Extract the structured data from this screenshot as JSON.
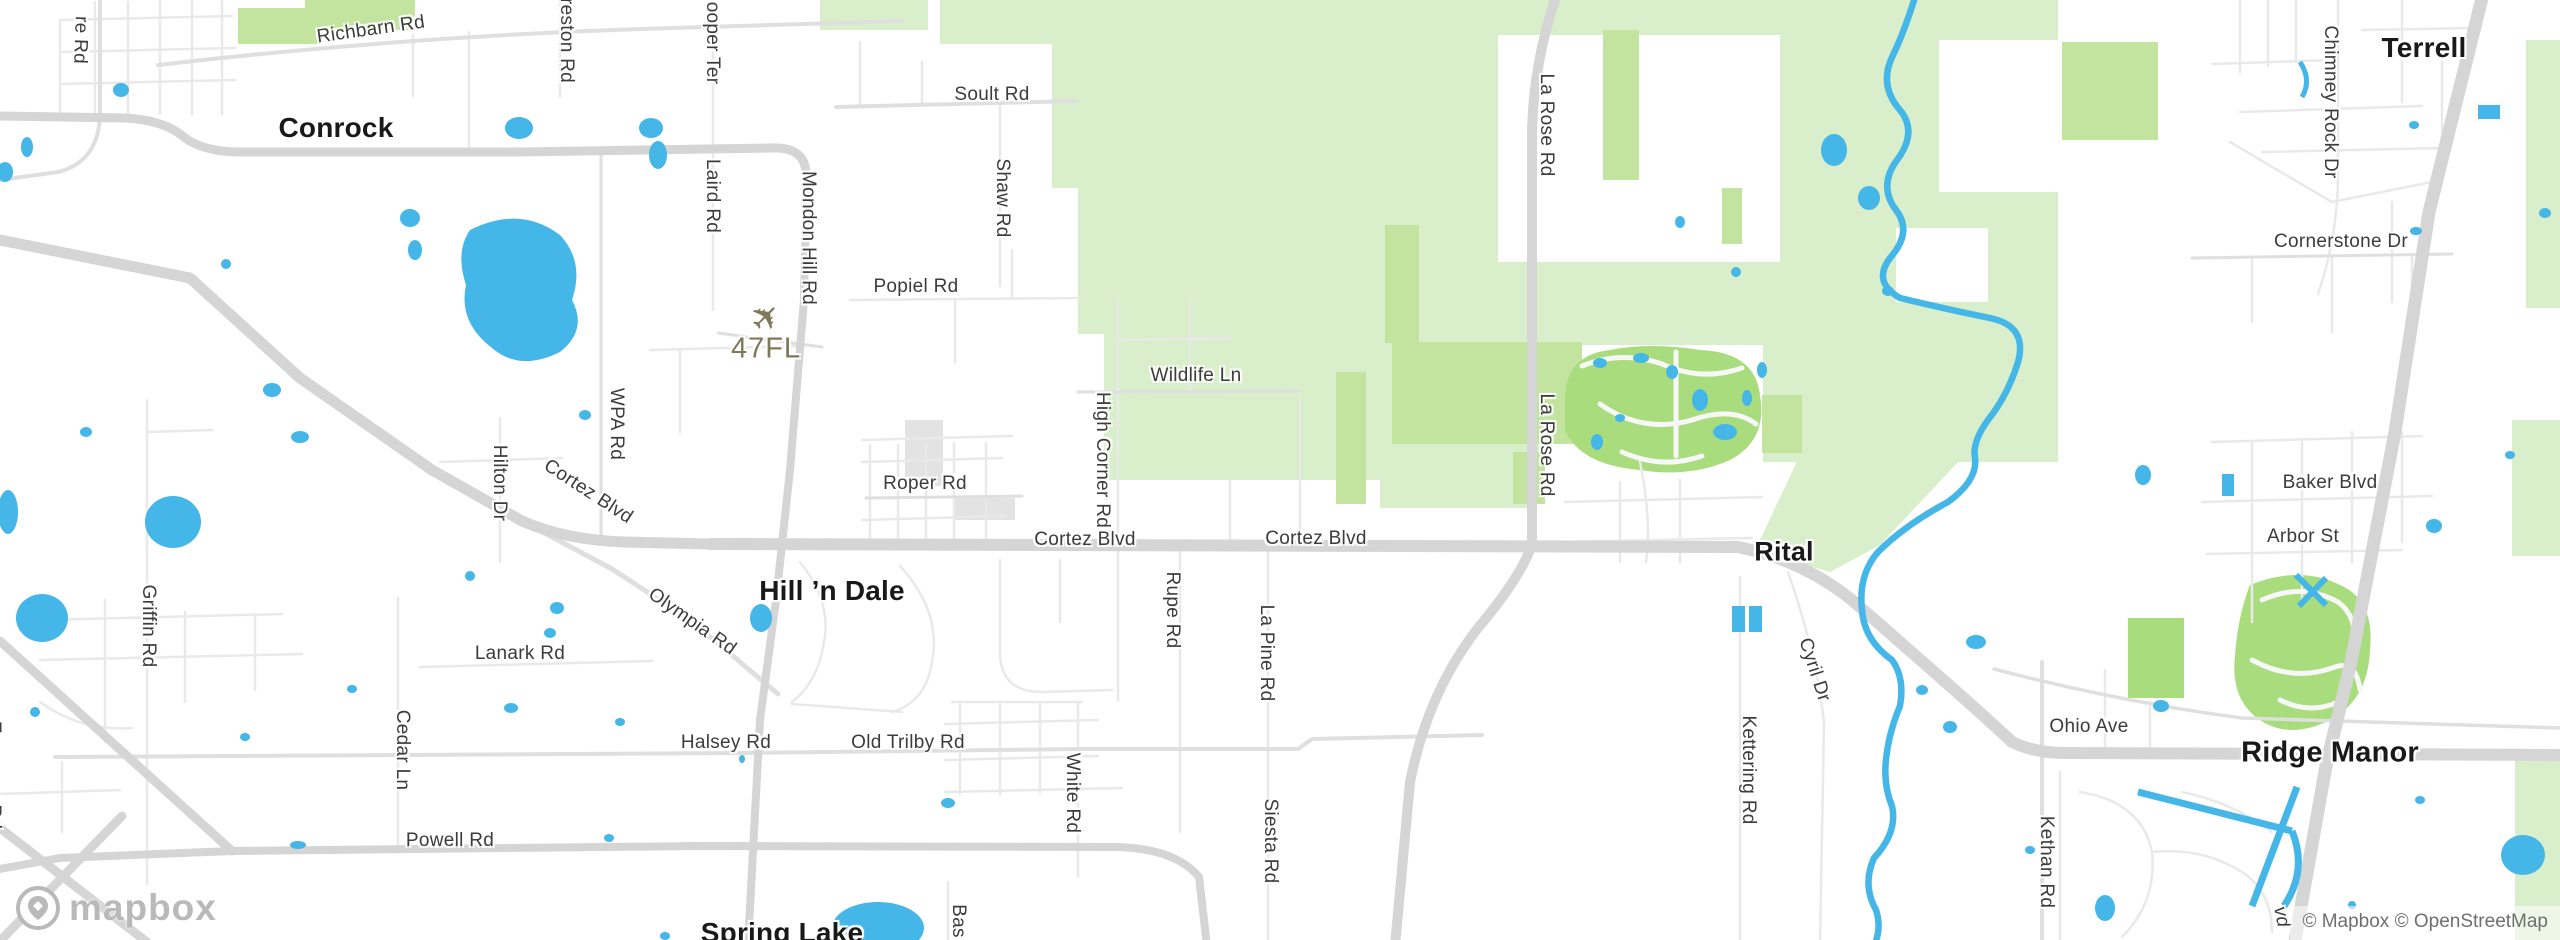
{
  "colors": {
    "water": "#45b6e8",
    "park": "#d9eeca",
    "park2": "#c2e49f",
    "golf": "#a9dc7d",
    "roadMajor": "#d5d5d5",
    "roadSecondary": "#dfdfdf",
    "roadMinor": "#e9e9e9",
    "building": "#e3e3e3",
    "roadLabel": "#3c3c3c",
    "placeLabel": "#191919",
    "airport": "#80785a",
    "attribution": "#6f6f6f",
    "logo": "#b9b9b9"
  },
  "attribution": "© Mapbox © OpenStreetMap",
  "logo_text": "mapbox",
  "airport": {
    "code": "47FL"
  },
  "icons": {
    "airplane": "✈"
  },
  "place_labels": [
    {
      "text": "Conrock",
      "x": 336,
      "y": 128,
      "size": 28
    },
    {
      "text": "Hill ’n Dale",
      "x": 832,
      "y": 591,
      "size": 28
    },
    {
      "text": "Spring Lake",
      "x": 782,
      "y": 933,
      "size": 28
    },
    {
      "text": "Rital",
      "x": 1784,
      "y": 552,
      "size": 27
    },
    {
      "text": "Terrell",
      "x": 2424,
      "y": 48,
      "size": 28
    },
    {
      "text": "Ridge Manor",
      "x": 2330,
      "y": 753,
      "size": 29
    }
  ],
  "road_labels": [
    {
      "text": "re Rd",
      "x": 80,
      "y": 40,
      "rot": 92
    },
    {
      "text": "Richbarn Rd",
      "x": 371,
      "y": 30,
      "rot": -8
    },
    {
      "text": "Preston Rd",
      "x": 566,
      "y": 34,
      "rot": 90
    },
    {
      "text": "Hooper Ter",
      "x": 712,
      "y": 36,
      "rot": 90
    },
    {
      "text": "Laird Rd",
      "x": 712,
      "y": 196,
      "rot": 90
    },
    {
      "text": "Soult Rd",
      "x": 992,
      "y": 95,
      "rot": 0
    },
    {
      "text": "Shaw Rd",
      "x": 1002,
      "y": 198,
      "rot": 90
    },
    {
      "text": "Mondon Hill Rd",
      "x": 808,
      "y": 238,
      "rot": 90
    },
    {
      "text": "Popiel Rd",
      "x": 916,
      "y": 287,
      "rot": 0
    },
    {
      "text": "WPA Rd",
      "x": 616,
      "y": 424,
      "rot": 90
    },
    {
      "text": "Cortez Blvd",
      "x": 588,
      "y": 492,
      "rot": 33
    },
    {
      "text": "Hilton Dr",
      "x": 499,
      "y": 483,
      "rot": 90
    },
    {
      "text": "Olympia Rd",
      "x": 692,
      "y": 622,
      "rot": 35
    },
    {
      "text": "Griffin Rd",
      "x": 148,
      "y": 626,
      "rot": 90
    },
    {
      "text": "Lanark Rd",
      "x": 520,
      "y": 654,
      "rot": 0
    },
    {
      "text": "Cedar Ln",
      "x": 402,
      "y": 750,
      "rot": 90
    },
    {
      "text": "Powell Rd",
      "x": 450,
      "y": 841,
      "rot": 0
    },
    {
      "text": "Halsey Rd",
      "x": 726,
      "y": 743,
      "rot": 0
    },
    {
      "text": "Old Trilby Rd",
      "x": 908,
      "y": 743,
      "rot": 0
    },
    {
      "text": "White Rd",
      "x": 1072,
      "y": 793,
      "rot": 90
    },
    {
      "text": "Bas",
      "x": 958,
      "y": 921,
      "rot": 90
    },
    {
      "text": "Rupe Rd",
      "x": 1172,
      "y": 610,
      "rot": 90
    },
    {
      "text": "La Pine Rd",
      "x": 1266,
      "y": 653,
      "rot": 90
    },
    {
      "text": "Siesta Rd",
      "x": 1270,
      "y": 841,
      "rot": 90
    },
    {
      "text": "High Corner Rd",
      "x": 1102,
      "y": 460,
      "rot": 90
    },
    {
      "text": "Wildlife Ln",
      "x": 1196,
      "y": 376,
      "rot": 0
    },
    {
      "text": "Roper Rd",
      "x": 925,
      "y": 484,
      "rot": 0
    },
    {
      "text": "Cortez Blvd",
      "x": 1085,
      "y": 540,
      "rot": 0
    },
    {
      "text": "Cortez Blvd",
      "x": 1316,
      "y": 539,
      "rot": 0
    },
    {
      "text": "La Rose Rd",
      "x": 1546,
      "y": 125,
      "rot": 90
    },
    {
      "text": "La Rose Rd",
      "x": 1546,
      "y": 445,
      "rot": 90
    },
    {
      "text": "Cyril Dr",
      "x": 1814,
      "y": 670,
      "rot": 72
    },
    {
      "text": "Kettering Rd",
      "x": 1748,
      "y": 770,
      "rot": 90
    },
    {
      "text": "Kethan Rd",
      "x": 2046,
      "y": 862,
      "rot": 90
    },
    {
      "text": "Ohio Ave",
      "x": 2089,
      "y": 727,
      "rot": 0
    },
    {
      "text": "Baker Blvd",
      "x": 2330,
      "y": 483,
      "rot": 0
    },
    {
      "text": "Arbor St",
      "x": 2303,
      "y": 537,
      "rot": 0
    },
    {
      "text": "Cornerstone Dr",
      "x": 2341,
      "y": 242,
      "rot": 0
    },
    {
      "text": "Chimney Rock Dr",
      "x": 2330,
      "y": 102,
      "rot": 90
    },
    {
      "text": "Emerson Rd",
      "x": -7,
      "y": 775,
      "rot": 90
    },
    {
      "text": "vd",
      "x": 2281,
      "y": 917,
      "rot": 78,
      "italic": true
    }
  ]
}
